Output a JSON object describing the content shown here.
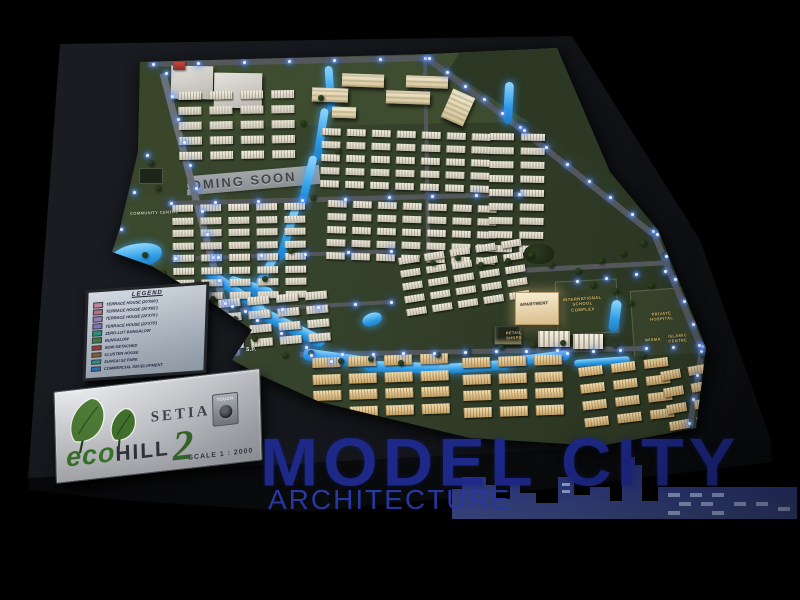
{
  "photo": {
    "subject": "Setia EcoHill 2 architectural scale model",
    "watermark": {
      "title": "MODEL CITY",
      "subtitle": "ARCHITECTURE"
    },
    "plaque": {
      "brand": "SETIA",
      "brand_eco": "eco",
      "brand_hill": "HILL",
      "brand_number": "2",
      "touch": "TOUCH",
      "scale": "SCALE 1 : 2000"
    },
    "coming_soon": "COMING SOON",
    "legend": {
      "title": "LEGEND",
      "items": [
        {
          "label": "TERRACE HOUSE (20'X60')",
          "color": "#c0879b"
        },
        {
          "label": "TERRACE HOUSE (20'X65')",
          "color": "#b16f88"
        },
        {
          "label": "TERRACE HOUSE (22'X70')",
          "color": "#9a7bb1"
        },
        {
          "label": "TERRACE HOUSE (22'X75')",
          "color": "#7f74b8"
        },
        {
          "label": "ZERO-LOT BUNGALOW",
          "color": "#2f8f7c"
        },
        {
          "label": "BUNGALOW",
          "color": "#3f7d3f"
        },
        {
          "label": "SEMI DETACHED",
          "color": "#a03636"
        },
        {
          "label": "CLUSTER HOUSE",
          "color": "#8a5a2c"
        },
        {
          "label": "SUNGAI S2 PARK",
          "color": "#2e8f8a"
        },
        {
          "label": "COMMERCIAL DEVELOPMENT",
          "color": "#2e6fae"
        }
      ]
    },
    "map_labels": [
      {
        "t": "COMMUNITY CENTRE",
        "x": 130,
        "y": 210,
        "s": 4,
        "c": "#c9d3ba",
        "r": -2
      },
      {
        "t": "S.P.",
        "x": 246,
        "y": 347,
        "s": 5,
        "c": "#e9eef3",
        "r": 0
      },
      {
        "t": "APARTMENT",
        "x": 520,
        "y": 301,
        "s": 4,
        "c": "#53493a",
        "r": -4
      },
      {
        "t": "INTERNATIONAL\nSCHOOL\nCOMPLEX",
        "x": 563,
        "y": 296,
        "s": 4.2,
        "c": "#d8bc6e",
        "r": -4
      },
      {
        "t": "RETAIL\nSHOPS",
        "x": 506,
        "y": 331,
        "s": 3.8,
        "c": "#d8bc6e",
        "r": -3
      },
      {
        "t": "PRIVATE\nHOSPITAL",
        "x": 650,
        "y": 311,
        "s": 4,
        "c": "#d8bc6e",
        "r": -4
      },
      {
        "t": "WISMA",
        "x": 645,
        "y": 337,
        "s": 4,
        "c": "#d8bc6e",
        "r": -4
      },
      {
        "t": "ISLAMIC\nCENTRE",
        "x": 668,
        "y": 333,
        "s": 4,
        "c": "#d8bc6e",
        "r": -4
      }
    ],
    "colors": {
      "background": "#000000",
      "board": "#15171c",
      "terrain_green": "#36432c",
      "water_blue": "#2f9ce6",
      "led_glow": "#79a8ff",
      "house_cream": "#e9e4d6",
      "house_gold": "#d9bd8a",
      "watermark_blue": "#1f2a8e",
      "label_gold": "#d8bc6e",
      "plaque_silver": "#c6c8cc",
      "leaf_green": "#4d7d36"
    }
  },
  "model": {
    "patches": [
      {
        "x": 140,
        "y": 50,
        "w": 420,
        "h": 75,
        "r": -1,
        "c": "#3e4c2f"
      },
      {
        "x": 455,
        "y": 48,
        "w": 240,
        "h": 95,
        "r": 33,
        "c": "#2c3824"
      },
      {
        "x": 128,
        "y": 62,
        "w": 60,
        "h": 210,
        "r": 2,
        "c": "#394629"
      },
      {
        "x": 112,
        "y": 196,
        "w": 115,
        "h": 78,
        "r": -2,
        "c": "#3b492d"
      },
      {
        "x": 556,
        "y": 280,
        "w": 60,
        "h": 52,
        "r": -3,
        "c": "#333f27",
        "b": "#59624a"
      },
      {
        "x": 632,
        "y": 288,
        "w": 82,
        "h": 68,
        "r": -4,
        "c": "#37422b",
        "b": "#59624a"
      },
      {
        "x": 584,
        "y": 356,
        "w": 118,
        "h": 84,
        "r": -3,
        "c": "#2e3a25"
      }
    ],
    "roads": [
      {
        "x": 163,
        "y": 70,
        "l": 292,
        "w": 7,
        "a": 75.3,
        "c": "#6e7274"
      },
      {
        "x": 148,
        "y": 61,
        "l": 281,
        "w": 6,
        "a": -1.2
      },
      {
        "x": 428,
        "y": 56,
        "l": 118,
        "w": 6,
        "a": 37
      },
      {
        "x": 522,
        "y": 127,
        "l": 167,
        "w": 6,
        "a": 38.5
      },
      {
        "x": 654,
        "y": 231,
        "l": 125,
        "w": 6,
        "a": 67.5
      },
      {
        "x": 702,
        "y": 347,
        "l": 78,
        "w": 6,
        "a": 99
      },
      {
        "x": 168,
        "y": 201,
        "l": 353,
        "w": 5,
        "a": -1.5
      },
      {
        "x": 172,
        "y": 257,
        "l": 221,
        "w": 4,
        "a": -2
      },
      {
        "x": 240,
        "y": 308,
        "l": 153,
        "w": 4,
        "a": -3
      },
      {
        "x": 300,
        "y": 352,
        "l": 345,
        "w": 5,
        "a": -1
      },
      {
        "x": 425,
        "y": 58,
        "l": 200,
        "w": 4,
        "a": 89
      },
      {
        "x": 520,
        "y": 268,
        "l": 150,
        "w": 5,
        "a": -3
      }
    ],
    "rivers": [
      {
        "x": 110,
        "y": 244,
        "w": 52,
        "h": 24,
        "r": -8,
        "blob": 1
      },
      {
        "x": 200,
        "y": 286,
        "w": 70,
        "h": 10,
        "r": 35
      },
      {
        "x": 248,
        "y": 320,
        "w": 80,
        "h": 12,
        "r": 26
      },
      {
        "x": 303,
        "y": 353,
        "w": 72,
        "h": 12,
        "r": 8
      },
      {
        "x": 365,
        "y": 362,
        "w": 80,
        "h": 11,
        "r": 2
      },
      {
        "x": 438,
        "y": 362,
        "w": 72,
        "h": 10,
        "r": -4
      },
      {
        "x": 500,
        "y": 354,
        "w": 70,
        "h": 10,
        "r": -7
      },
      {
        "x": 326,
        "y": 66,
        "w": 8,
        "h": 46,
        "r": -4
      },
      {
        "x": 317,
        "y": 108,
        "w": 8,
        "h": 52,
        "r": 9
      },
      {
        "x": 303,
        "y": 155,
        "w": 8,
        "h": 56,
        "r": 14
      },
      {
        "x": 284,
        "y": 205,
        "w": 8,
        "h": 56,
        "r": 17
      },
      {
        "x": 260,
        "y": 252,
        "w": 8,
        "h": 46,
        "r": 30
      },
      {
        "x": 228,
        "y": 282,
        "w": 46,
        "h": 9,
        "r": 18
      },
      {
        "x": 504,
        "y": 82,
        "w": 9,
        "h": 42,
        "r": 3
      },
      {
        "x": 610,
        "y": 300,
        "w": 10,
        "h": 32,
        "r": 8
      },
      {
        "x": 574,
        "y": 358,
        "w": 56,
        "h": 7,
        "r": -4
      },
      {
        "x": 362,
        "y": 313,
        "w": 20,
        "h": 13,
        "r": -15,
        "blob": 1
      }
    ],
    "clusters": [
      {
        "x": 178,
        "y": 92,
        "rw": 5,
        "cl": 4,
        "bw": 23,
        "bh": 8,
        "gx": 8,
        "gy": 7,
        "r": -1,
        "c": "w"
      },
      {
        "x": 172,
        "y": 205,
        "rw": 8,
        "cl": 5,
        "bw": 21,
        "bh": 7,
        "gx": 7,
        "gy": 5.5,
        "r": -1,
        "c": "w"
      },
      {
        "x": 218,
        "y": 300,
        "rw": 4,
        "cl": 4,
        "bw": 22,
        "bh": 8,
        "gx": 7,
        "gy": 6,
        "r": -5,
        "c": "w"
      },
      {
        "x": 322,
        "y": 128,
        "rw": 5,
        "cl": 7,
        "bw": 19,
        "bh": 6.5,
        "gx": 6,
        "gy": 6.5,
        "r": 2,
        "c": "w"
      },
      {
        "x": 328,
        "y": 200,
        "rw": 5,
        "cl": 7,
        "bw": 19,
        "bh": 6.5,
        "gx": 6,
        "gy": 6.5,
        "r": 2,
        "c": "w"
      },
      {
        "x": 490,
        "y": 133,
        "rw": 9,
        "cl": 2,
        "bw": 24,
        "bh": 7,
        "gx": 7,
        "gy": 7,
        "r": 1,
        "c": "w"
      },
      {
        "x": 398,
        "y": 258,
        "rw": 5,
        "cl": 5,
        "bw": 20,
        "bh": 7,
        "gx": 6,
        "gy": 6,
        "r": -9,
        "c": "w"
      },
      {
        "x": 312,
        "y": 358,
        "rw": 4,
        "cl": 4,
        "bw": 28,
        "bh": 10,
        "gx": 8,
        "gy": 6.5,
        "r": -2,
        "c": "g"
      },
      {
        "x": 462,
        "y": 358,
        "rw": 4,
        "cl": 3,
        "bw": 28,
        "bh": 10,
        "gx": 8,
        "gy": 6.5,
        "r": -2,
        "c": "g"
      },
      {
        "x": 578,
        "y": 368,
        "rw": 4,
        "cl": 3,
        "bw": 24,
        "bh": 9,
        "gx": 9,
        "gy": 8,
        "r": -7,
        "c": "g"
      },
      {
        "x": 660,
        "y": 372,
        "rw": 4,
        "cl": 2,
        "bw": 20,
        "bh": 9,
        "gx": 8,
        "gy": 8,
        "r": -10,
        "c": "g"
      }
    ],
    "slabs": [
      {
        "x": 342,
        "y": 74,
        "w": 42,
        "h": 12,
        "r": 2
      },
      {
        "x": 406,
        "y": 76,
        "w": 42,
        "h": 11,
        "r": 2
      },
      {
        "x": 312,
        "y": 88,
        "w": 36,
        "h": 13,
        "r": 2
      },
      {
        "x": 386,
        "y": 91,
        "w": 44,
        "h": 12,
        "r": 2
      },
      {
        "x": 446,
        "y": 92,
        "w": 24,
        "h": 30,
        "r": 24
      },
      {
        "x": 332,
        "y": 107,
        "w": 24,
        "h": 10,
        "r": 2
      },
      {
        "x": 171,
        "y": 66,
        "w": 42,
        "h": 32,
        "r": 1,
        "flat": 1
      },
      {
        "x": 214,
        "y": 73,
        "w": 48,
        "h": 34,
        "r": 1,
        "flat": 1
      }
    ],
    "buildings": [
      {
        "t": "apt",
        "x": 515,
        "y": 292,
        "w": 42,
        "h": 31
      },
      {
        "t": "dark",
        "x": 524,
        "y": 244,
        "w": 30,
        "h": 20
      },
      {
        "t": "retail",
        "x": 494,
        "y": 326,
        "w": 26,
        "h": 17
      },
      {
        "t": "shop",
        "x": 538,
        "y": 331,
        "w": 32,
        "h": 16
      },
      {
        "t": "shop",
        "x": 573,
        "y": 334,
        "w": 30,
        "h": 15
      },
      {
        "t": "red",
        "x": 173,
        "y": 62,
        "w": 12,
        "h": 8
      },
      {
        "t": "sign",
        "x": 139,
        "y": 168,
        "w": 22,
        "h": 14
      }
    ],
    "leds": [
      {
        "x1": 165,
        "y1": 72,
        "x2": 236,
        "y2": 348,
        "n": 13
      },
      {
        "x1": 152,
        "y1": 63,
        "x2": 424,
        "y2": 57,
        "n": 7
      },
      {
        "x1": 428,
        "y1": 57,
        "x2": 519,
        "y2": 126,
        "n": 6
      },
      {
        "x1": 523,
        "y1": 129,
        "x2": 652,
        "y2": 230,
        "n": 7
      },
      {
        "x1": 656,
        "y1": 233,
        "x2": 701,
        "y2": 345,
        "n": 6
      },
      {
        "x1": 700,
        "y1": 350,
        "x2": 688,
        "y2": 422,
        "n": 4
      },
      {
        "x1": 206,
        "y1": 291,
        "x2": 330,
        "y2": 360,
        "n": 6
      },
      {
        "x1": 310,
        "y1": 354,
        "x2": 556,
        "y2": 349,
        "n": 9
      },
      {
        "x1": 566,
        "y1": 352,
        "x2": 698,
        "y2": 344,
        "n": 6
      },
      {
        "x1": 170,
        "y1": 202,
        "x2": 518,
        "y2": 193,
        "n": 9
      },
      {
        "x1": 174,
        "y1": 257,
        "x2": 390,
        "y2": 250,
        "n": 6
      },
      {
        "x1": 576,
        "y1": 280,
        "x2": 664,
        "y2": 270,
        "n": 4
      },
      {
        "x1": 244,
        "y1": 310,
        "x2": 390,
        "y2": 301,
        "n": 5
      },
      {
        "x1": 120,
        "y1": 228,
        "x2": 146,
        "y2": 154,
        "n": 3
      }
    ]
  }
}
